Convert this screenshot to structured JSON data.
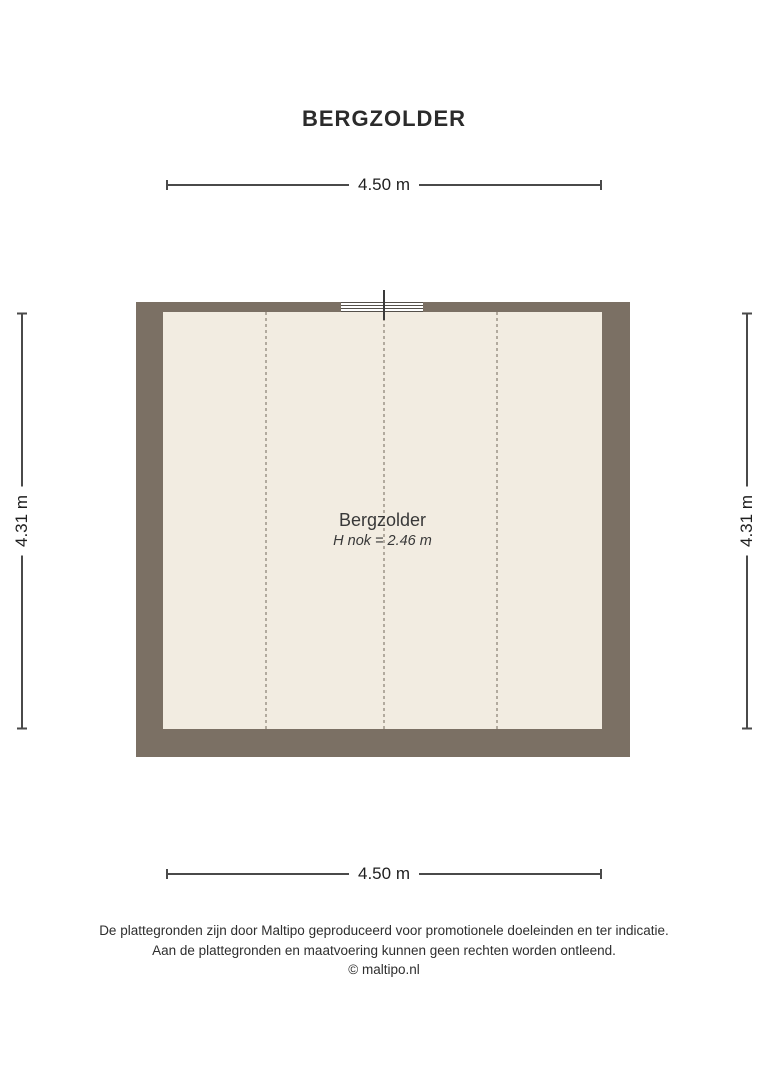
{
  "title": "BERGZOLDER",
  "room": {
    "name": "Bergzolder",
    "height_note": "H nok = 2.46 m"
  },
  "dimensions": {
    "top": "4.50 m",
    "bottom": "4.50 m",
    "left": "4.31 m",
    "right": "4.31 m"
  },
  "footer": {
    "line1": "De plattegronden zijn door Maltipo geproduceerd voor promotionele doeleinden en ter indicatie.",
    "line2": "Aan de plattegronden en maatvoering kunnen geen rechten worden ontleend.",
    "line3": "© maltipo.nl"
  },
  "colors": {
    "wall": "#7b7064",
    "floor": "#f2ece1",
    "roof_dash": "#b2aa9e",
    "dim_line": "#4a4a4a",
    "text": "#2d2d2d"
  }
}
